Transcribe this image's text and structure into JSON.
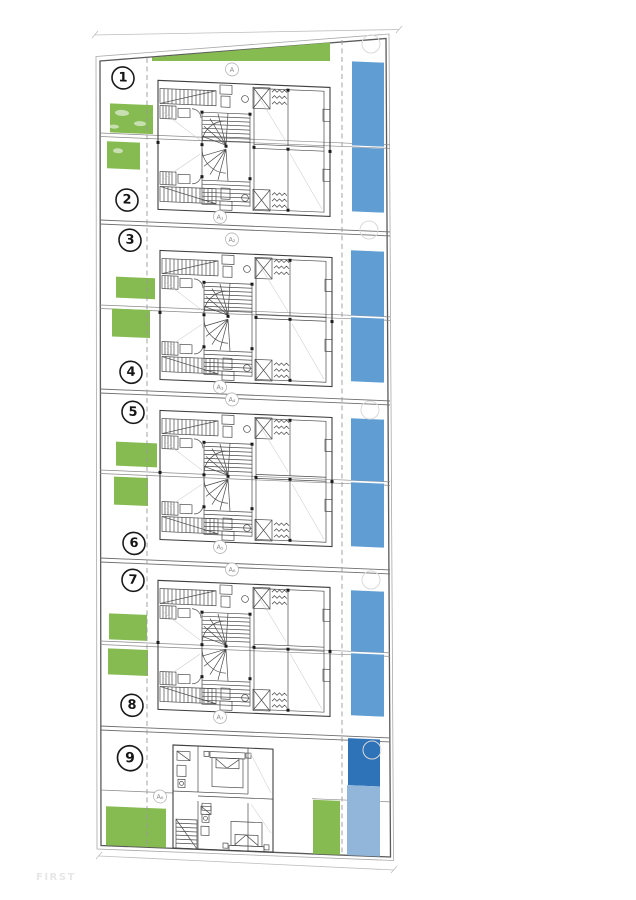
{
  "watermark": "FIRST",
  "units": [
    {
      "number": "1"
    },
    {
      "number": "2"
    },
    {
      "number": "3"
    },
    {
      "number": "4"
    },
    {
      "number": "5"
    },
    {
      "number": "6"
    },
    {
      "number": "7"
    },
    {
      "number": "8"
    },
    {
      "number": "9"
    }
  ],
  "markers": [
    {
      "label": "A"
    },
    {
      "label": "A₁"
    },
    {
      "label": "A₂"
    },
    {
      "label": "A₃"
    },
    {
      "label": "A₄"
    },
    {
      "label": "A₅"
    },
    {
      "label": "A₆"
    },
    {
      "label": "A₇"
    },
    {
      "label": "A₈"
    }
  ],
  "colors": {
    "lawn": "#86bb52",
    "pool": "#5f9dd3",
    "pool_dark": "#2e72b8",
    "pool_light": "#92b6da",
    "line": "#4a4a4a",
    "boundary": "#5a5a5a",
    "watermark_color": "#e7e7e7"
  }
}
